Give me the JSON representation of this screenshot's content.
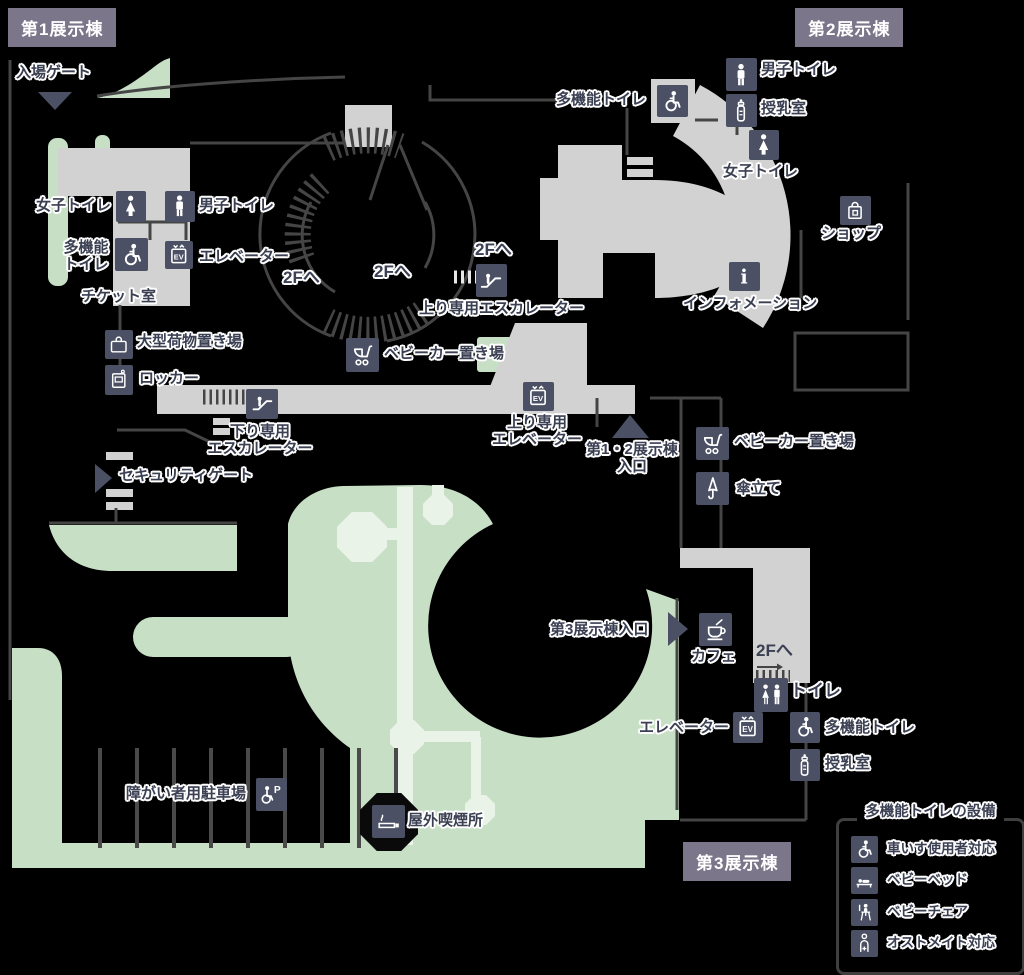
{
  "colors": {
    "background": "#000000",
    "badge_bg": "#7b7689",
    "badge_text": "#ffffff",
    "icon_tile_bg": "#4b5064",
    "icon_glyph": "#ffffff",
    "walkway_gray": "#d2d2d2",
    "greenery": "#c7dfc5",
    "path_light_green": "#eaf3e8",
    "wall_line": "#454545",
    "label_text": "#3b4053",
    "label_outline": "#ffffff",
    "marker_triangle": "#4b5064"
  },
  "badges": {
    "hall1": "第1展示棟",
    "hall2": "第2展示棟",
    "hall3": "第3展示棟"
  },
  "labels": {
    "entrance_gate": "入場ゲート",
    "womens_toilet": "女子トイレ",
    "mens_toilet": "男子トイレ",
    "multi_toilet_2line": "多機能\nトイレ",
    "multi_toilet": "多機能トイレ",
    "elevator": "エレベーター",
    "ticket_room": "チケット室",
    "to_2f": "2Fへ",
    "up_escalator": "上り専用エスカレーター",
    "down_escalator_2line": "下り専用\nエスカレーター",
    "up_elevator_2line": "上り専用\nエレベーター",
    "stroller_area": "ベビーカー置き場",
    "luggage_area": "大型荷物置き場",
    "locker": "ロッカー",
    "security_gate": "セキュリティゲート",
    "hall12_entrance_2line": "第1・2展示棟\n入口",
    "umbrella_stand": "傘立て",
    "nursing_room": "授乳室",
    "shop": "ショップ",
    "information": "インフォメーション",
    "hall3_entrance": "第3展示棟入口",
    "cafe": "カフェ",
    "toilet": "トイレ",
    "disabled_parking": "障がい者用駐車場",
    "smoking_area": "屋外喫煙所"
  },
  "legend": {
    "title": "多機能トイレの設備",
    "items": [
      "車いす使用者対応",
      "ベビーベッド",
      "ベビーチェア",
      "オストメイト対応"
    ]
  },
  "icons": [
    "woman",
    "man",
    "wheelchair",
    "elevator-ev",
    "escalator",
    "stroller",
    "umbrella",
    "information-i",
    "shopping-bag",
    "coffee-cup",
    "baby-bottle",
    "luggage",
    "locker",
    "toilets-pair",
    "wheelchair-parking",
    "cigarette",
    "baby-bed",
    "baby-chair",
    "ostomate"
  ]
}
